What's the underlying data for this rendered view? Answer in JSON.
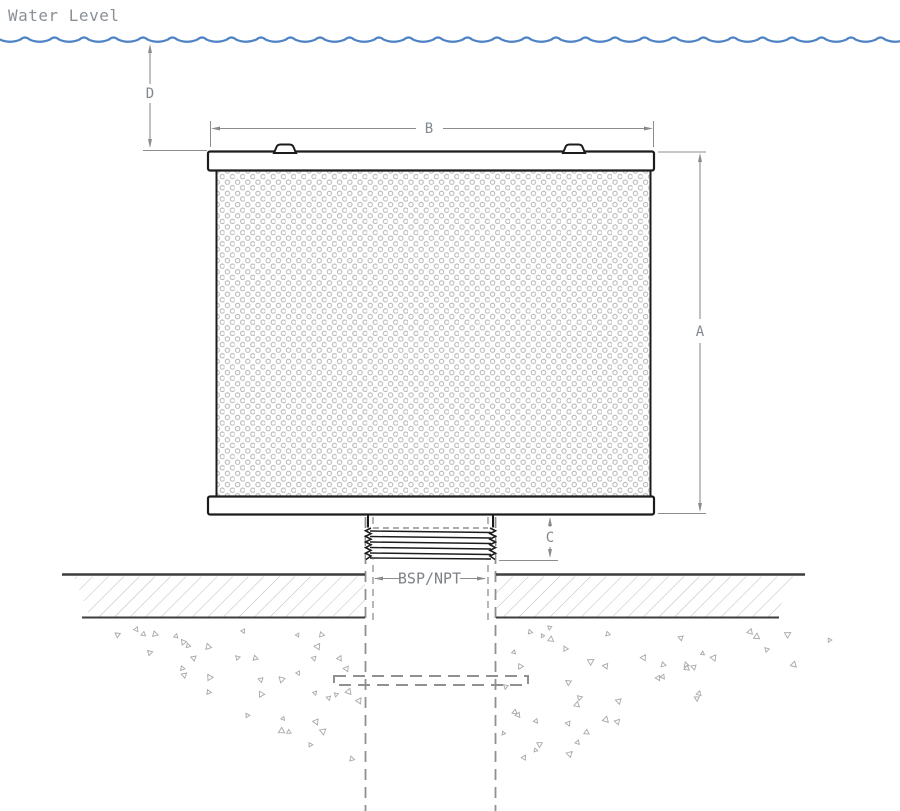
{
  "labels": {
    "water_level": "Water Level",
    "dim_a": "A",
    "dim_b": "B",
    "dim_c": "C",
    "dim_d": "D",
    "thread_standard": "BSP/NPT"
  },
  "colors": {
    "water_line": "#4d82c4",
    "drawing_ink": "#1c1c1c",
    "ground_ink": "#3d3d3d",
    "dimension_line": "#8c8c8c",
    "label_text": "#82888d",
    "mesh_dot": "#b4b4b4",
    "hatch_line": "#bcbcbc",
    "stipple": "#a8a8a8",
    "hidden_line": "#909090"
  }
}
